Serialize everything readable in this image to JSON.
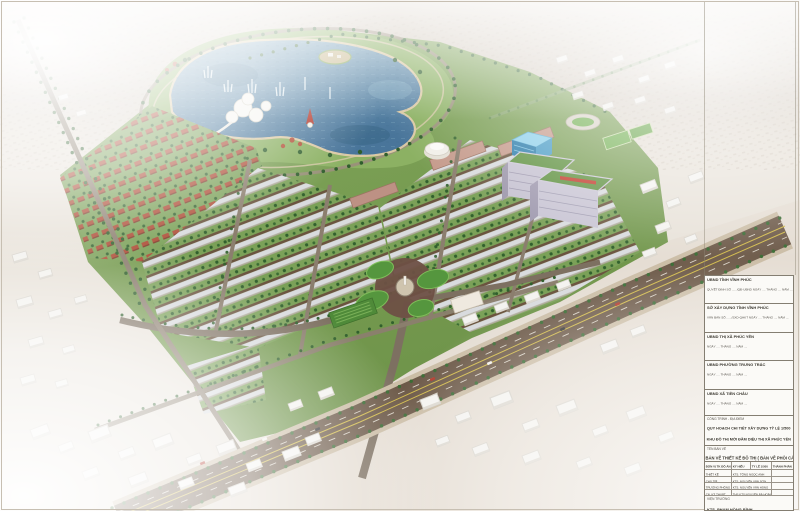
{
  "titleblock": {
    "approvals": [
      {
        "org": "UBND TỈNH VĨNH PHÚC",
        "note": "QUYẾT ĐỊNH SỐ ....../QĐ-UBND   NGÀY .... THÁNG .... NĂM ...."
      },
      {
        "org": "SỞ XÂY DỰNG TỈNH VĨNH PHÚC",
        "note": "VĂN BẢN SỐ ....../SXD-QHKT   NGÀY .... THÁNG .... NĂM ...."
      },
      {
        "org": "UBND THỊ XÃ PHÚC YÊN",
        "note": "NGÀY .... THÁNG .... NĂM ...."
      },
      {
        "org": "UBND PHƯỜNG TRƯNG TRẮC",
        "note": "NGÀY .... THÁNG .... NĂM ...."
      },
      {
        "org": "UBND XÃ TIỀN CHÂU",
        "note": "NGÀY .... THÁNG .... NĂM ...."
      }
    ],
    "project_label": "CÔNG TRÌNH - ĐỊA ĐIỂM",
    "project_line1": "QUY HOẠCH CHI TIẾT XÂY DỰNG TỶ LỆ 1/500",
    "project_line2": "KHU ĐÔ THỊ MỚI ĐẦM DIỆU THỊ XÃ PHÚC YÊN",
    "project_line3": "(KHU ĐÔ THỊ TM HUYPTERRA)",
    "drawing_label": "TÊN BẢN VẼ",
    "drawing_title": "BẢN VẼ THIẾT KẾ ĐÔ THỊ ( BẢN VẼ PHỐI CẢNH )",
    "table": {
      "col1": "ĐƠN VỊ TK ĐỒ ÁN",
      "col2": "KÝ HIỆU",
      "col3": "TỶ LỆ 1/500",
      "col4": "THÀNH PHẦN",
      "rows": [
        {
          "role": "THIẾT KẾ",
          "name": "KTS. TỐNG NGỌC ANH"
        },
        {
          "role": "CHỦ TRÌ",
          "name": "KTS. NGUYỄN VĂN SƠN"
        },
        {
          "role": "TRƯỞNG PHÒNG",
          "name": "KTS. NGUYỄN VĂN HÙNG"
        },
        {
          "role": "CN. KỸ THUẬT",
          "name": "THS.KTS NGUYỄN BÁ HOÀNG"
        }
      ],
      "director_label": "VIỆN TRƯỞNG",
      "director_name": "KTS. PHẠM HỒNG BÌNH"
    }
  },
  "scene": {
    "type": "3d-aerial-masterplan-rendering",
    "features": [
      "lake-water-park",
      "fountains",
      "island",
      "white-pavilions",
      "lighthouse",
      "villa-rows-red-roofs",
      "shophouse-rows",
      "apartment-slabs-green-roofs",
      "blue-glass-building",
      "white-dome-hall",
      "stadium",
      "sports-fields",
      "roundabout-with-monument",
      "tree-lined-boulevards",
      "main-highway",
      "existing-city-white-massing",
      "haze-horizon"
    ],
    "palette": {
      "water": "#5b87a3",
      "water_deep": "#3f6d8c",
      "water_light": "#8fb7cc",
      "park_green": "#7ba158",
      "lawn_green": "#55963e",
      "tree_green": "#31602d",
      "sand": "#d9c8a4",
      "roof_grey": "#d9dbde",
      "facade_brown": "#6b543f",
      "roof_red": "#ad4c35",
      "road_grey": "#8b7e6e",
      "plaza_brown": "#6e5044",
      "highway_brown": "#6d5a49",
      "median_yellow": "#d2bb4c",
      "context_white": "#f4f3f0",
      "haze_tan": "#d3cabf",
      "tower_lavender": "#c6c2d1",
      "tower_roof_green": "#5f9140",
      "glass_blue": "#2c7dab",
      "sign_red": "#c23a2b"
    }
  }
}
